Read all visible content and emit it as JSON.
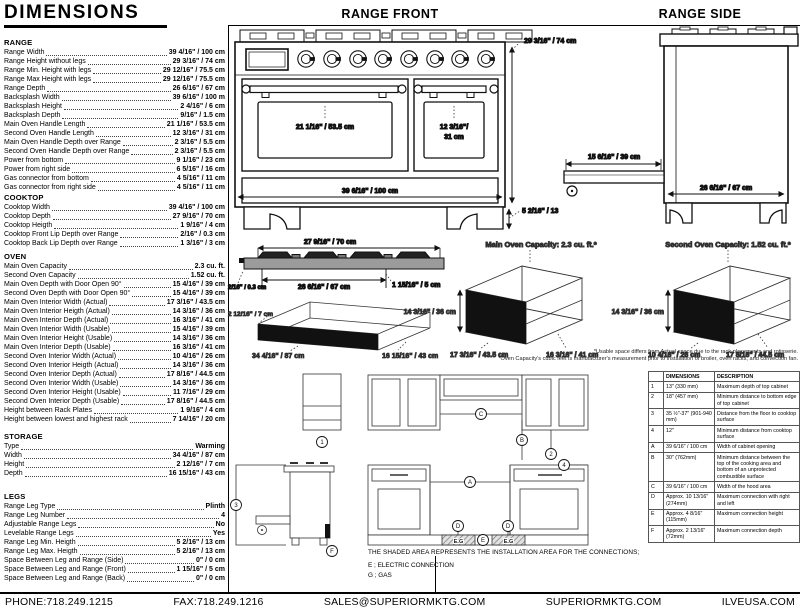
{
  "title": "DIMENSIONS",
  "specs": {
    "sections": [
      {
        "name": "RANGE",
        "rows": [
          [
            "Range Width",
            "39 4/16\" / 100 cm"
          ],
          [
            "Range Height without legs",
            "29 3/16\" / 74 cm"
          ],
          [
            "Range Min. Height with legs",
            "29 12/16\" / 75.5 cm"
          ],
          [
            "Range Max Height with legs",
            "29 12/16\" / 75.5 cm"
          ],
          [
            "Range Depth",
            "26 6/16\" / 67 cm"
          ],
          [
            "Backsplash Width",
            "39 6/16\" / 100 m"
          ],
          [
            "Backsplash Height",
            "2 4/16\" / 6 cm"
          ],
          [
            "Backsplash Depth",
            "9/16\" / 1.5 cm"
          ],
          [
            "Main Oven Handle Length",
            "21 1/16\" / 53.5 cm"
          ],
          [
            "Second Oven Handle Length",
            "12 3/16\" / 31 cm"
          ],
          [
            "Main Oven Handle Depth over Range",
            "2 3/16\" / 5.5 cm"
          ],
          [
            "Second Oven Handle Depth over Range",
            "2 3/16\" / 5.5 cm"
          ],
          [
            "Power from bottom",
            "9 1/16\" / 23 cm"
          ],
          [
            "Power from right side",
            "6 5/16\" / 16 cm"
          ],
          [
            "Gas connector from bottom",
            "4 5/16\" / 11 cm"
          ],
          [
            "Gas connector from right side",
            "4 5/16\" / 11 cm"
          ]
        ]
      },
      {
        "name": "COOKTOP",
        "rows": [
          [
            "Cooktop Width",
            "39 4/16\" / 100 cm"
          ],
          [
            "Cooktop Depth",
            "27 9/16\" / 70 cm"
          ],
          [
            "Cooktop Heigth",
            "1 9/16\" / 4 cm"
          ],
          [
            "Cooktop Front Lip Depth over Range",
            "2/16\" / 0.3 cm"
          ],
          [
            "Cooktop Back Lip Depth over Range",
            "1 3/16\" / 3 cm"
          ]
        ]
      },
      {
        "name": "OVEN",
        "rows": [
          [
            "Main Oven Capacity",
            "2.3 cu. ft."
          ],
          [
            "Second Oven Capacity",
            "1.52 cu. ft."
          ],
          [
            "Main Oven Depth with Door Open 90°",
            "15 4/16\" / 39 cm"
          ],
          [
            "Second Oven Depth with Door Open 90°",
            "15 4/16\" / 39 cm"
          ],
          [
            "Main Oven Interior Width (Actual)",
            "17 3/16\" / 43.5 cm"
          ],
          [
            "Main Oven Interior Heigth (Actual)",
            "14 3/16\" / 36 cm"
          ],
          [
            "Main Oven Interior Depth (Actual)",
            "16 3/16\" / 41 cm"
          ],
          [
            "Main Oven Interior Width (Usable)",
            "15 4/16\" / 39 cm"
          ],
          [
            "Main Oven Interior Height (Usable)",
            "14 3/16\" / 36 cm"
          ],
          [
            "Main Oven Interior Depth (Usable)",
            "16 3/16\" / 41 cm"
          ],
          [
            "Second Oven Interior Width (Actual)",
            "10 4/16\" / 26 cm"
          ],
          [
            "Second Oven Interior Heigth (Actual)",
            "14 3/16\" / 36 cm"
          ],
          [
            "Second Oven Interior Depth (Actual)",
            "17 8/16\" / 44.5 cm"
          ],
          [
            "Second Oven Interior Width (Usable)",
            "14 3/16\" / 36 cm"
          ],
          [
            "Second Oven Interior Height (Usable)",
            "11 7/16\" / 29 cm"
          ],
          [
            "Second Oven Interior Depth (Usable)",
            "17 8/16\" / 44.5 cm"
          ],
          [
            "Height between Rack Plates",
            "1 9/16\" / 4 cm"
          ],
          [
            "Height between lowest and highest rack",
            "7 14/16\" / 20 cm"
          ]
        ]
      },
      {
        "name": "STORAGE",
        "rows": [
          [
            "Type",
            "Warming"
          ],
          [
            "Width",
            "34 4/16\" / 87 cm"
          ],
          [
            "Height",
            "2 12/16\" / 7 cm"
          ],
          [
            "Depth",
            "16 15/16\" / 43 cm"
          ]
        ]
      },
      {
        "name": "LEGS",
        "rows": [
          [
            "Range Leg Type",
            "Plinth"
          ],
          [
            "Range Leg Number",
            "4"
          ],
          [
            "Adjustable Range Legs",
            "No"
          ],
          [
            "Levelable Range Legs",
            "Yes"
          ],
          [
            "Range Leg Min. Heigth",
            "5 2/16\" / 13 cm"
          ],
          [
            "Range Leg Max. Heigth",
            "5 2/16\" / 13 cm"
          ],
          [
            "Space Between Leg and Range (Side)",
            "0\" / 0 cm"
          ],
          [
            "Space Between Leg and Range (Front)",
            "1 15/16\" / 5 cm"
          ],
          [
            "Space Between Leg and Range (Back)",
            "0\" / 0 cm"
          ]
        ]
      }
    ]
  },
  "diagrams": {
    "range_front": {
      "title": "RANGE FRONT",
      "main_handle": "21 1/16\" / 53.5 cm",
      "second_handle_1": "12 3/16\"/",
      "second_handle_2": "31 cm",
      "width": "39 6/16\" / 100 cm",
      "height": "29 3/16\" / 74 cm",
      "leg": "5 2/16\" / 13"
    },
    "range_side": {
      "title": "RANGE SIDE",
      "door_open": "15 6/16\" / 39 cm",
      "depth": "26 6/16\" / 67 cm"
    },
    "cooktop": {
      "top": "27 9/16\" / 70 cm",
      "mid": "26 6/16\" / 67 cm",
      "front_lip": "2/16\" / 0.3 cm",
      "back": "1 15/16\" / 5 cm"
    },
    "storage": {
      "height": "2 12/16\" / 7 cm",
      "width": "34 4/16\" / 87 cm",
      "depth": "16 15/16\" / 43 cm"
    },
    "main_oven": {
      "title": "Main Oven Capacity: 2.3 cu. ft.*",
      "height": "14 3/16\" / 36 cm",
      "width": "17 3/16\" / 43.5 cm",
      "depth": "16 3/16\" / 41 cm"
    },
    "second_oven": {
      "title": "Second Oven Capacity: 1.52 cu. ft.*",
      "height": "14 3/16\" / 36 cm",
      "width": "10 4/16\" / 26 cm",
      "depth": "17 8/16\" / 44.5 cm"
    }
  },
  "footnotes": [
    "*Usable space differs from Actual space due to the rack placements and rotisserie.",
    "*Oven Capacity's cubic feet is manufacturer's measurement prior to installation of broiler, oven racks, and convection fan."
  ],
  "installation": {
    "note": "THE SHADED AREA REPRESENTS THE INSTALLATION AREA FOR THE CONNECTIONS;",
    "legend": [
      "E ; ELECTRIC CONNECTION",
      "G ; GAS"
    ],
    "eg": "E.G",
    "markers": {
      "n1": "1",
      "n2": "2",
      "n3": "3",
      "n4": "4",
      "a": "A",
      "b": "B",
      "c": "C",
      "d": "D",
      "e": "E",
      "f": "F"
    }
  },
  "reference_table": {
    "headers": [
      "",
      "DIMENSIONS",
      "DESCRIPTION"
    ],
    "rows": [
      [
        "1",
        "13\" (330 mm)",
        "Maximum depth of top cabinet"
      ],
      [
        "2",
        "18\" (457 mm)",
        "Minimum distance to bottom edge of top cabinet"
      ],
      [
        "3",
        "35 ½\"-37\" (901-940 mm)",
        "Distance from the floor to cooktop surface"
      ],
      [
        "4",
        "12\"",
        "Minimum distance from cooktop surface"
      ],
      [
        "A",
        "39 6/16\" / 100 cm",
        "Width of cabinet opening"
      ],
      [
        "B",
        "30\" (762mm)",
        "Minimum distance between the top of the cooking area and bottom of an unprotected combustible surface"
      ],
      [
        "C",
        "39 6/16\" / 100 cm",
        "Width of the hood area"
      ],
      [
        "D",
        "Approx. 10 13/16\" (274mm)",
        "Maximum connection with right and left"
      ],
      [
        "E",
        "Approx. 4 8/16\" (115mm)",
        "Maximum connection height"
      ],
      [
        "F",
        "Approx. 2 13/16\" (72mm)",
        "Maximum connection depth"
      ]
    ]
  },
  "footer": {
    "phone": "PHONE:718.249.1215",
    "fax": "FAX:718.249.1216",
    "email": "SALES@SUPERIORMKTG.COM",
    "site": "SUPERIORMKTG.COM",
    "site2": "ILVEUSA.COM"
  },
  "colors": {
    "ink": "#111111",
    "slab_gray": "#9b9b9b",
    "panel_black": "#111111"
  }
}
